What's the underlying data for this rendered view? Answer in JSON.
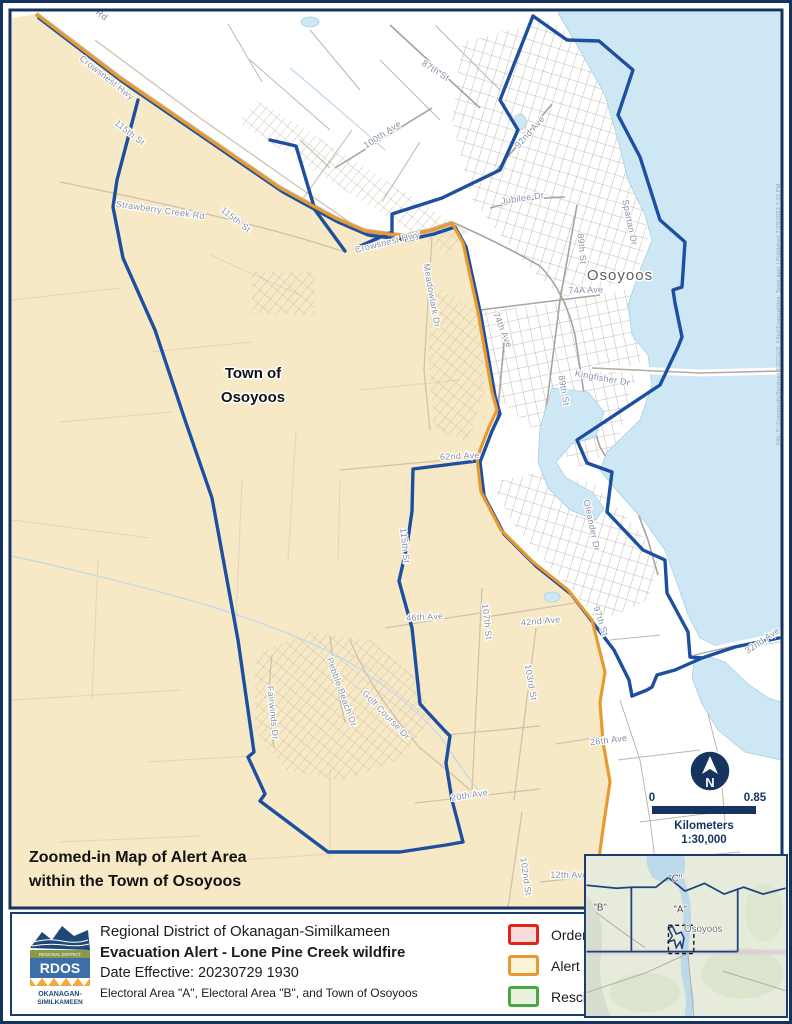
{
  "page": {
    "background": "#ffffff",
    "border_color": "#14345f"
  },
  "map": {
    "colors": {
      "alert_fill": "#f8e9c6",
      "alert_boundary": "#e79a2e",
      "municipal_boundary": "#1d4fa1",
      "water": "#cde7f5",
      "roads_rural": "#cdc3ac",
      "roads_urban": "#b3ada4",
      "frame": "#16335f"
    },
    "street_labels": [
      {
        "text": "Rd",
        "x": 100,
        "y": 17,
        "rot": 38
      },
      {
        "text": "Crowsnest Hwy",
        "x": 105,
        "y": 80,
        "rot": 38
      },
      {
        "text": "115th St",
        "x": 128,
        "y": 135,
        "rot": 38
      },
      {
        "text": "Strawberry Creek Rd",
        "x": 160,
        "y": 213,
        "rot": 8
      },
      {
        "text": "115th St",
        "x": 234,
        "y": 222,
        "rot": 38
      },
      {
        "text": "87th St",
        "x": 434,
        "y": 73,
        "rot": 33
      },
      {
        "text": "100th Ave",
        "x": 384,
        "y": 137,
        "rot": -33
      },
      {
        "text": "92nd Ave",
        "x": 532,
        "y": 134,
        "rot": -48
      },
      {
        "text": "Jubilee Dr",
        "x": 523,
        "y": 201,
        "rot": -8
      },
      {
        "text": "Crowsnest Hwy",
        "x": 388,
        "y": 245,
        "rot": -14
      },
      {
        "text": "Meadowlark Dr",
        "x": 429,
        "y": 296,
        "rot": 80
      },
      {
        "text": "Spartan Dr",
        "x": 627,
        "y": 223,
        "rot": 78
      },
      {
        "text": "89th St",
        "x": 579,
        "y": 249,
        "rot": 84
      },
      {
        "text": "74A Ave",
        "x": 586,
        "y": 293,
        "rot": -2
      },
      {
        "text": "74th Ave",
        "x": 500,
        "y": 331,
        "rot": 68
      },
      {
        "text": "89th St",
        "x": 561,
        "y": 391,
        "rot": 80
      },
      {
        "text": "Kingfisher Dr",
        "x": 602,
        "y": 381,
        "rot": 10
      },
      {
        "text": "62nd Ave",
        "x": 460,
        "y": 459,
        "rot": -3
      },
      {
        "text": "Oleander Dr",
        "x": 589,
        "y": 526,
        "rot": 78
      },
      {
        "text": "115th St",
        "x": 402,
        "y": 546,
        "rot": 84
      },
      {
        "text": "46th Ave",
        "x": 425,
        "y": 620,
        "rot": -3
      },
      {
        "text": "107th St",
        "x": 484,
        "y": 622,
        "rot": 84
      },
      {
        "text": "42nd Ave",
        "x": 541,
        "y": 624,
        "rot": -5
      },
      {
        "text": "103rd St",
        "x": 528,
        "y": 683,
        "rot": 80
      },
      {
        "text": "97th St",
        "x": 598,
        "y": 622,
        "rot": 72
      },
      {
        "text": "26th Ave",
        "x": 609,
        "y": 743,
        "rot": -7
      },
      {
        "text": "32nd Ave",
        "x": 764,
        "y": 643,
        "rot": -34
      },
      {
        "text": "Fairwinds Dr",
        "x": 270,
        "y": 713,
        "rot": 84
      },
      {
        "text": "Pebble Beach Dr",
        "x": 339,
        "y": 693,
        "rot": 70
      },
      {
        "text": "Golf Course Dr",
        "x": 384,
        "y": 717,
        "rot": 46
      },
      {
        "text": "20th Ave",
        "x": 470,
        "y": 798,
        "rot": -9
      },
      {
        "text": "102nd St",
        "x": 523,
        "y": 877,
        "rot": 82
      },
      {
        "text": "12th Ave",
        "x": 569,
        "y": 878,
        "rot": 0
      }
    ],
    "labels": {
      "city": "Osoyoos",
      "town_line1": "Town of",
      "town_line2": "Osoyoos",
      "caption_line1": "Zoomed-in Map of Alert Area",
      "caption_line2": "within the Town of Osoyoos"
    },
    "scale": {
      "zero": "0",
      "max": "0.85",
      "units": "Kilometers",
      "ratio": "1:30,000"
    },
    "north_letter": "N",
    "attribution": "File: P:\\CommunityServices\\EOC\\GIS_Files\\Evacuations_Tests.aprx | Published 7/29/2023 7:15 PM"
  },
  "inset": {
    "area_c": "\"C\"",
    "area_b": "\"B\"",
    "area_a": "\"A\"",
    "osoyoos": "Osoyoos"
  },
  "footer": {
    "org": "Regional District of Okanagan-Similkameen",
    "title": "Evacuation Alert - Lone Pine Creek wildfire",
    "date": "Date Effective: 20230729 1930",
    "areas": "Electoral Area \"A\", Electoral Area \"B\", and Town of Osoyoos",
    "logo": {
      "band": "REGIONAL DISTRICT",
      "acronym": "RDOS",
      "name_line1": "OKANAGAN-",
      "name_line2": "SIMILKAMEEN"
    },
    "legend": [
      {
        "key": "order",
        "label": "Order",
        "stroke": "#e1251b",
        "fill": "#f8dcda"
      },
      {
        "key": "alert",
        "label": "Alert",
        "stroke": "#e79a2e",
        "fill": "#fdf3d9"
      },
      {
        "key": "rescind",
        "label": "Rescind",
        "stroke": "#47a942",
        "fill": "#e9f2df"
      }
    ]
  }
}
